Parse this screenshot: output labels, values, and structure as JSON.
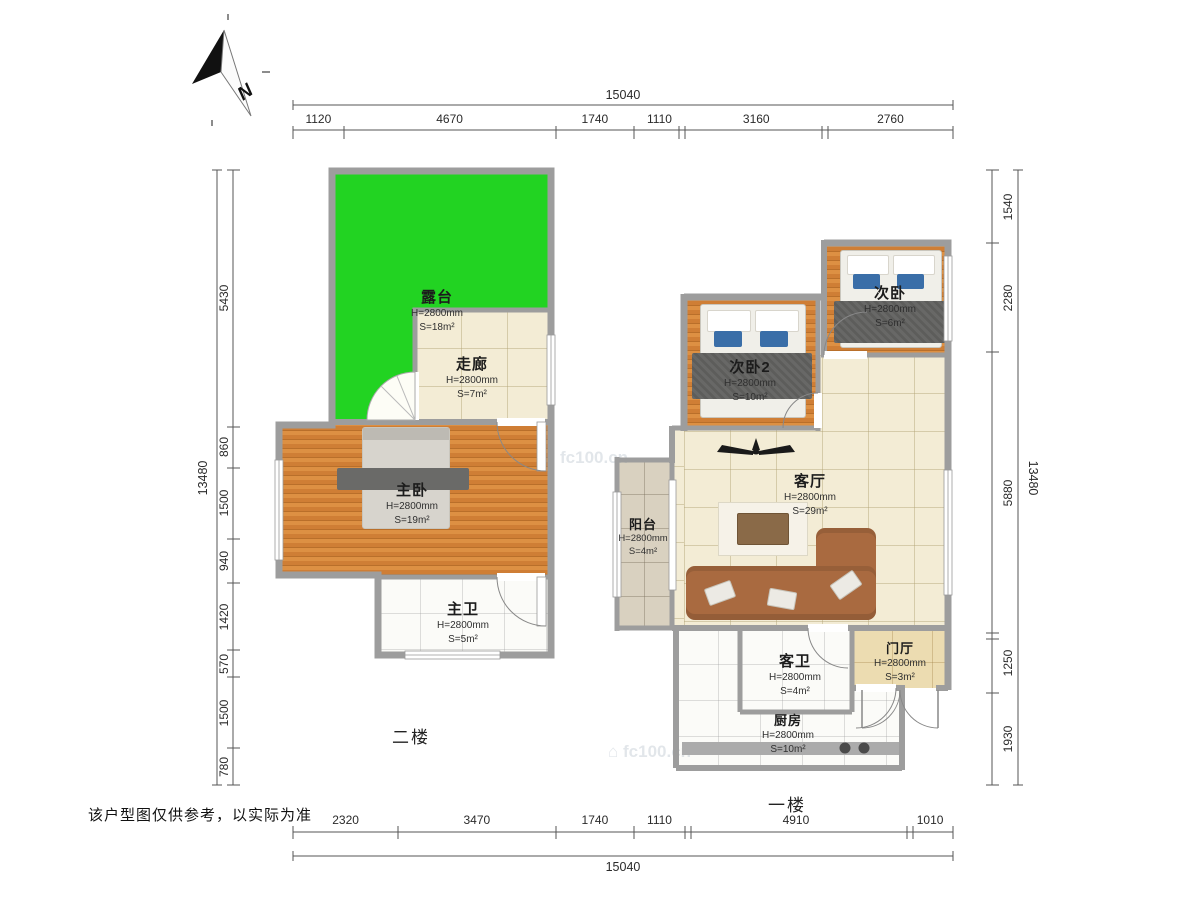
{
  "meta": {
    "floor2_label": "二楼",
    "floor1_label": "一楼",
    "disclaimer": "该户型图仅供参考，以实际为准",
    "compass_letter": "N",
    "watermark": "fc100.cn"
  },
  "dims": {
    "top": {
      "total": "15040",
      "segments": [
        "1120",
        "4670",
        "1740",
        "1110",
        "3160",
        "2760"
      ]
    },
    "bottom": {
      "total": "15040",
      "segments": [
        "2320",
        "3470",
        "1740",
        "1110",
        "4910",
        "1010"
      ]
    },
    "left": {
      "total": "13480",
      "segments": [
        "5430",
        "860",
        "1500",
        "940",
        "1420",
        "570",
        "1500",
        "780"
      ]
    },
    "right": {
      "total": "13480",
      "segments": [
        "1540",
        "2280",
        "5880",
        "1250",
        "1930"
      ]
    }
  },
  "rooms": {
    "lutai": {
      "name": "露台",
      "height": "H=2800mm",
      "area": "S=18m²"
    },
    "zoulang": {
      "name": "走廊",
      "height": "H=2800mm",
      "area": "S=7m²"
    },
    "zhuwo": {
      "name": "主卧",
      "height": "H=2800mm",
      "area": "S=19m²"
    },
    "zhuwei": {
      "name": "主卫",
      "height": "H=2800mm",
      "area": "S=5m²"
    },
    "ciwo": {
      "name": "次卧",
      "height": "H=2800mm",
      "area": "S=6m²"
    },
    "ciwo2": {
      "name": "次卧2",
      "height": "H=2800mm",
      "area": "S=10m²"
    },
    "keting": {
      "name": "客厅",
      "height": "H=2800mm",
      "area": "S=29m²"
    },
    "yangtai": {
      "name": "阳台",
      "height": "H=2800mm",
      "area": "S=4m²"
    },
    "kewei": {
      "name": "客卫",
      "height": "H=2800mm",
      "area": "S=4m²"
    },
    "menting": {
      "name": "门厅",
      "height": "H=2800mm",
      "area": "S=3m²"
    },
    "chufang": {
      "name": "厨房",
      "height": "H=2800mm",
      "area": "S=10m²"
    }
  },
  "colors": {
    "terrace_green": "#22d322",
    "wood_floor": "#d08038",
    "tile_beige": "#f3ecd5",
    "wall_gray": "#9d9d9d",
    "sofa_brown": "#a96a40"
  }
}
